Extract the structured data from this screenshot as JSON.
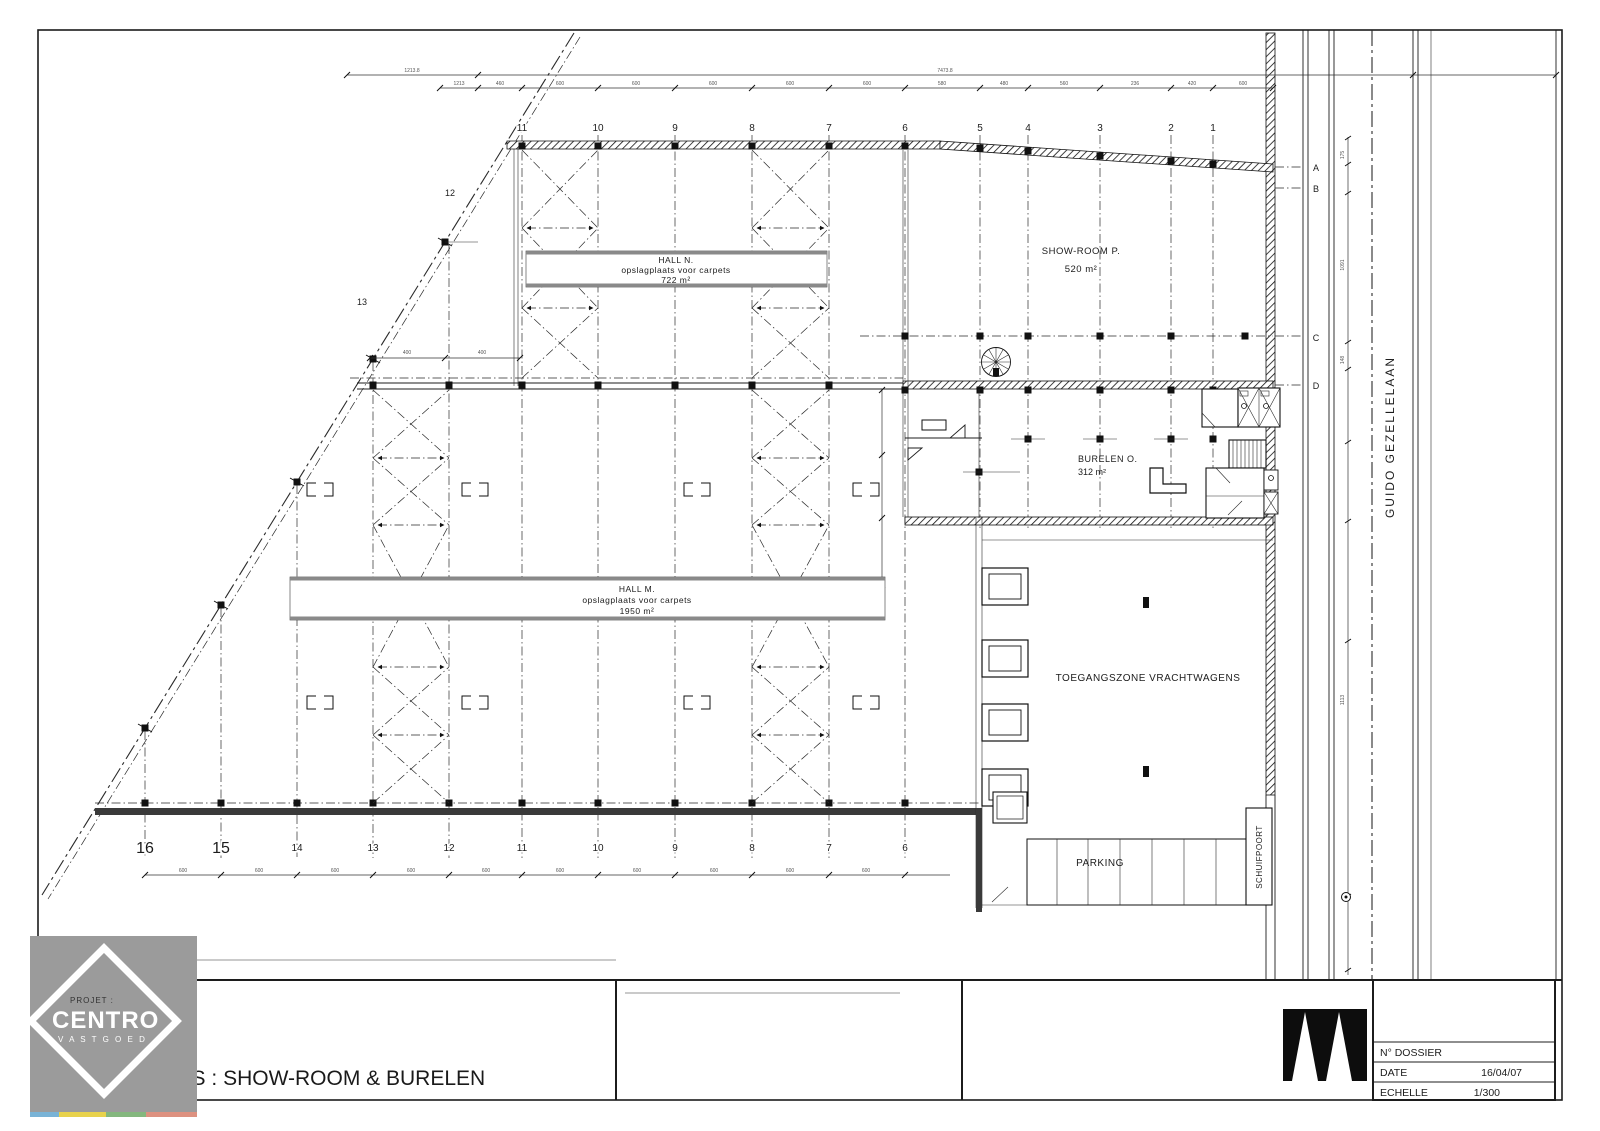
{
  "plan": {
    "rooms": {
      "hall_n": {
        "name": "HALL  N.",
        "desc": "opslagplaats voor  carpets",
        "area": "722  m²"
      },
      "hall_m": {
        "name": "HALL  M.",
        "desc": "opslagplaats  voor   carpets",
        "area": "1950  m²"
      },
      "showroom": {
        "name": "SHOW-ROOM   P.",
        "area": "520 m²"
      },
      "burelen": {
        "name": "BURELEN  O.",
        "area": "312 m²"
      },
      "truck_zone": {
        "name": "TOEGANGSZONE  VRACHTWAGENS"
      },
      "parking": {
        "name": "PARKING"
      },
      "gate": {
        "name": "SCHUIFPOORT"
      }
    },
    "street": {
      "name": "GUIDO  GEZELLELAAN"
    },
    "grid": {
      "top": [
        "11",
        "10",
        "9",
        "8",
        "7",
        "6",
        "5",
        "4",
        "3",
        "2",
        "1"
      ],
      "bottom": [
        "16",
        "15",
        "14",
        "13",
        "12",
        "11",
        "10",
        "9",
        "8",
        "7",
        "6"
      ],
      "rows": [
        "A",
        "B",
        "C",
        "D"
      ],
      "diagonal": [
        "12",
        "13"
      ]
    },
    "dims": {
      "overall": [
        "1213.8",
        "7473.8"
      ],
      "top": [
        "1213",
        "460",
        "600",
        "600",
        "600",
        "600",
        "600",
        "580",
        "480",
        "560",
        "236",
        "420",
        "600"
      ],
      "bottom": [
        "600",
        "600",
        "600",
        "600",
        "600",
        "600",
        "600",
        "600",
        "600",
        "600"
      ],
      "left": [
        "400",
        "400"
      ],
      "road": [
        "175",
        "1091",
        "148",
        "1113"
      ]
    }
  },
  "title_block": {
    "project_label": "PROJET :",
    "brand": "CENTRO",
    "brand_sub": "V A S T G O E D",
    "drawing_title": "GELIJKVLOERS : SHOW-ROOM & BURELEN",
    "table": {
      "dossier_label": "N° DOSSIER",
      "date_label": "DATE",
      "date_value": "16/04/07",
      "scale_label": "ECHELLE",
      "scale_value": "1/300"
    }
  },
  "colors": {
    "line": "#1c1c1c",
    "logo_bg": "#9b9b9b",
    "accent_strip": [
      "#79b3d6",
      "#e8d24c",
      "#84b77e",
      "#dd9180"
    ]
  }
}
